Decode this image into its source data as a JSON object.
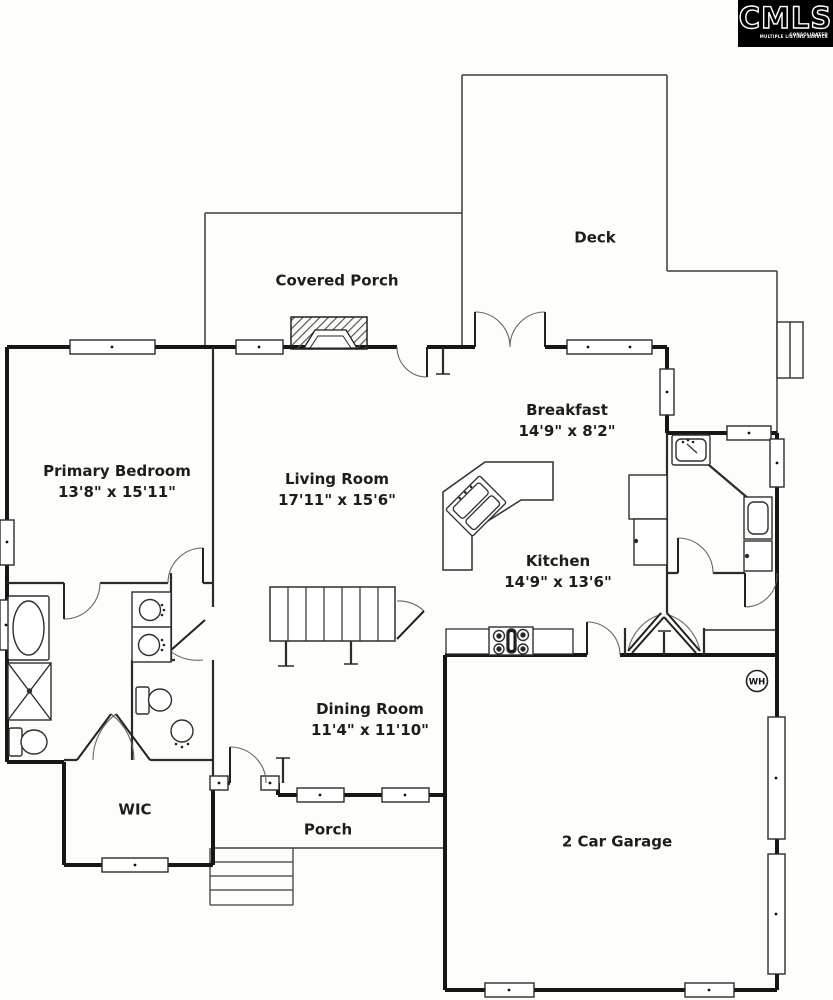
{
  "logo": {
    "text": "CMLS",
    "subtext_line1": "CONSOLIDATED",
    "subtext_line2": "MULTIPLE LISTING SERVICE"
  },
  "rooms": {
    "deck": {
      "name": "Deck",
      "dims": ""
    },
    "covered_porch": {
      "name": "Covered Porch",
      "dims": ""
    },
    "breakfast": {
      "name": "Breakfast",
      "dims": "14'9\" x 8'2\""
    },
    "primary_bedroom": {
      "name": "Primary Bedroom",
      "dims": "13'8\" x 15'11\""
    },
    "living_room": {
      "name": "Living Room",
      "dims": "17'11\" x 15'6\""
    },
    "kitchen": {
      "name": "Kitchen",
      "dims": "14'9\" x 13'6\""
    },
    "dining_room": {
      "name": "Dining Room",
      "dims": "11'4\" x 11'10\""
    },
    "wic": {
      "name": "WIC",
      "dims": ""
    },
    "porch": {
      "name": "Porch",
      "dims": ""
    },
    "garage": {
      "name": "2 Car Garage",
      "dims": ""
    }
  },
  "annotations": {
    "water_heater": "WH"
  },
  "colors": {
    "wall": "#161616",
    "interior_wall": "#2b2b2b",
    "thin_line": "#3d3d3d",
    "label_text": "#1d1d1d",
    "background": "#fdfdfa",
    "logo_bg": "#000000",
    "logo_fg": "#ffffff"
  }
}
